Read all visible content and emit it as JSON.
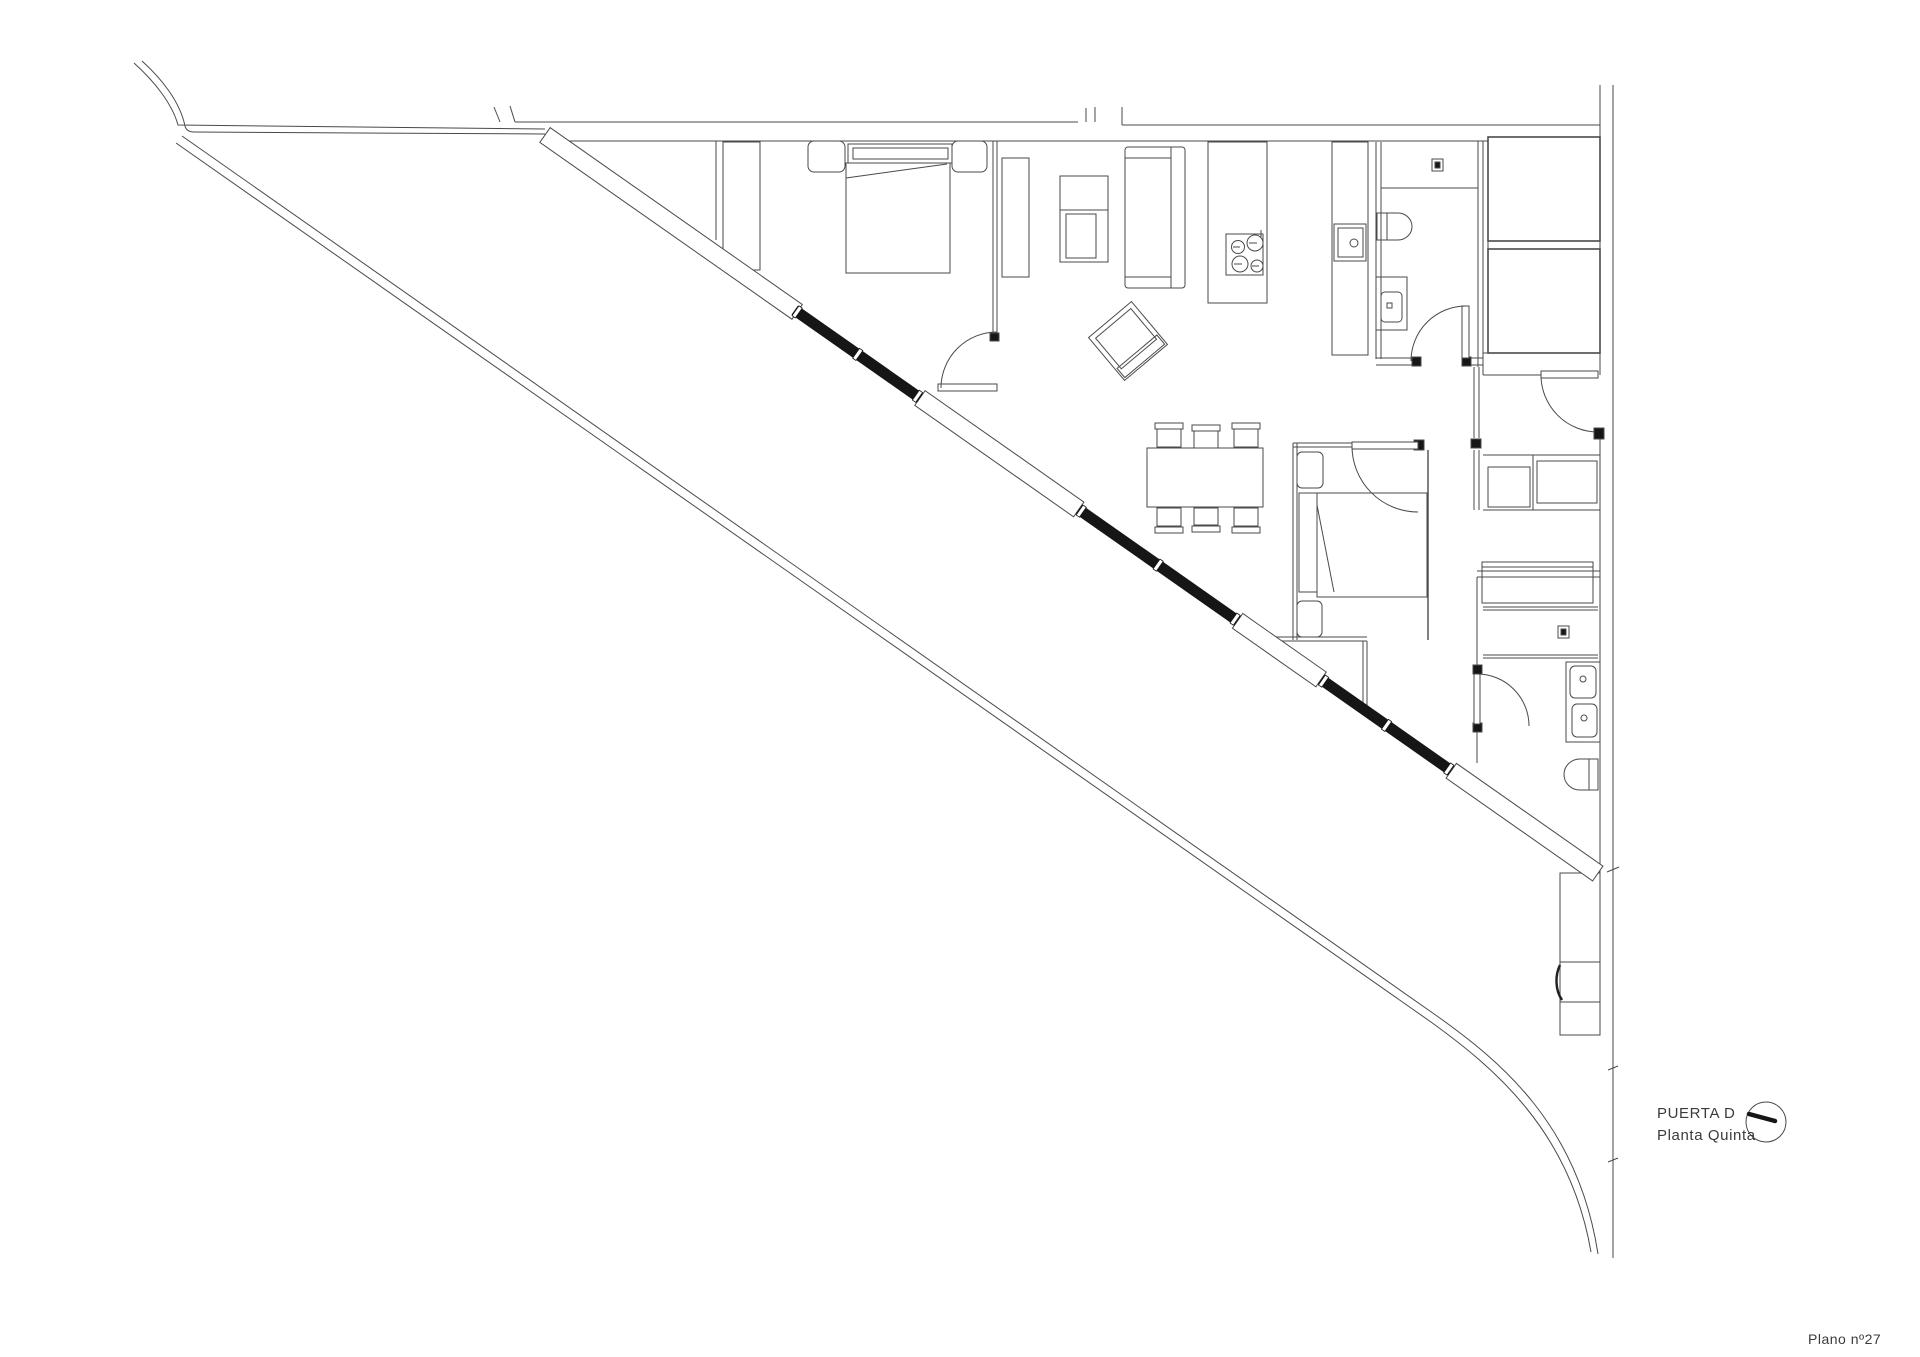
{
  "title_block": {
    "unit_label": "PUERTA D",
    "floor_label": "Planta Quinta",
    "plan_number": "Plano nº27"
  },
  "icons": {
    "compass": "north-arrow-icon"
  },
  "colors": {
    "background": "#ffffff",
    "line": "#4a4a4a",
    "dark": "#161616"
  }
}
